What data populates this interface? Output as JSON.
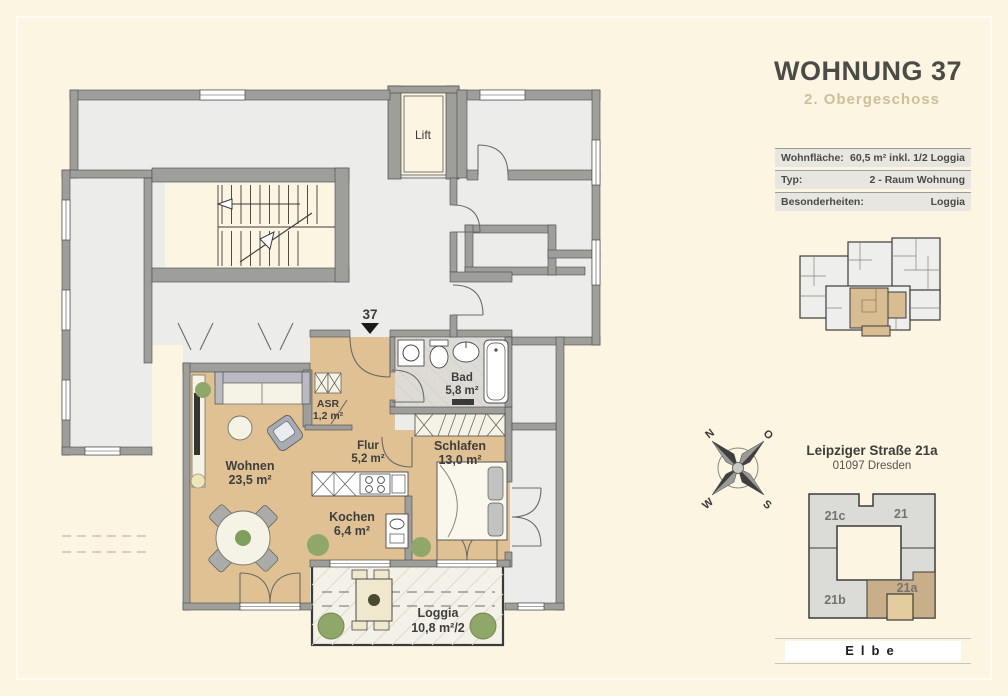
{
  "header": {
    "title": "WOHNUNG 37",
    "subtitle": "2. Obergeschoss"
  },
  "info_table": {
    "rows": [
      {
        "label": "Wohnfläche:",
        "value": "60,5 m² inkl. 1/2 Loggia"
      },
      {
        "label": "Typ:",
        "value": "2 - Raum Wohnung"
      },
      {
        "label": "Besonderheiten:",
        "value": "Loggia"
      }
    ]
  },
  "floor_plan": {
    "unit_marker": "37",
    "lift_label": "Lift",
    "rooms": [
      {
        "name": "Wohnen",
        "area": "23,5 m²"
      },
      {
        "name": "ASR",
        "area": "1,2 m²"
      },
      {
        "name": "Flur",
        "area": "5,2 m²"
      },
      {
        "name": "Schlafen",
        "area": "13,0 m²"
      },
      {
        "name": "Bad",
        "area": "5,8 m²"
      },
      {
        "name": "Kochen",
        "area": "6,4 m²"
      },
      {
        "name": "Loggia",
        "area": "10,8 m²/2"
      }
    ],
    "colors": {
      "wall": "#9E9E9A",
      "wood": "#DFC194",
      "neighbor": "#ECECEA",
      "bath_tile": "#DEDBD6",
      "loggia": "#F4F2E8",
      "plant": "#8FA869",
      "highlight": "#1A1A18"
    }
  },
  "compass": {
    "n": "N",
    "e": "O",
    "s": "S",
    "w": "W"
  },
  "address": {
    "street": "Leipziger Straße 21a",
    "city": "01097 Dresden"
  },
  "site_plan": {
    "buildings": [
      {
        "label": "21c"
      },
      {
        "label": "21"
      },
      {
        "label": "21b"
      },
      {
        "label": "21a",
        "highlighted": true
      }
    ],
    "river_label": "Elbe",
    "colors": {
      "building": "#DBDBD8",
      "highlight_building": "#C8AF89",
      "highlight_unit": "#E3CD9F"
    }
  }
}
